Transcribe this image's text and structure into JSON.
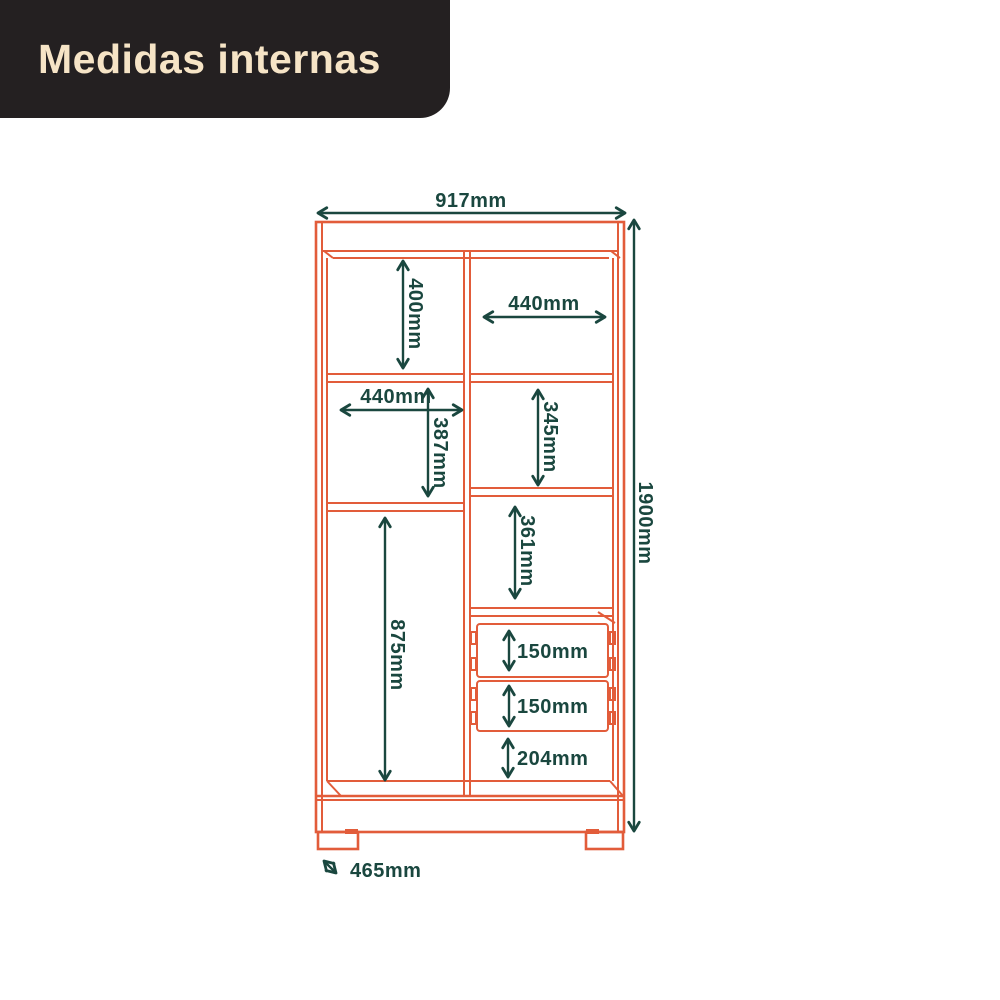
{
  "header": {
    "title": "Medidas internas",
    "bg_color": "#242021",
    "text_color": "#F6E4C6"
  },
  "drawing": {
    "type": "furniture-internal-dimensions-diagram",
    "outline_color": "#E25C3A",
    "dimension_color": "#1A473F",
    "dimensions": {
      "total_width": "917mm",
      "total_height": "1900mm",
      "depth": "465mm",
      "top_left_compartment_height": "400mm",
      "top_right_compartment_width": "440mm",
      "mid_left_compartment_width": "440mm",
      "mid_left_compartment_height": "387mm",
      "mid_right_compartment_height": "345mm",
      "lower_right_compartment_height": "361mm",
      "tall_left_compartment_height": "875mm",
      "drawer_1_height": "150mm",
      "drawer_2_height": "150mm",
      "bottom_right_compartment_height": "204mm"
    }
  }
}
